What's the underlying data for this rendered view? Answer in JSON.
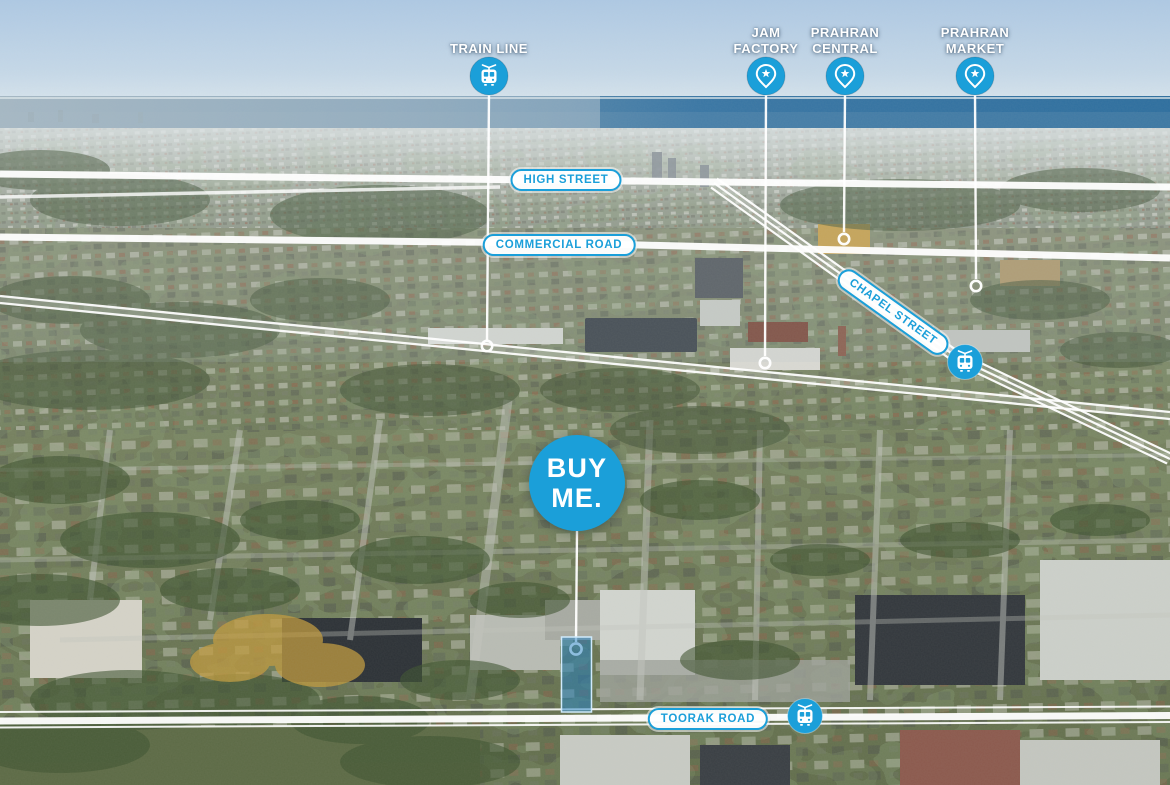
{
  "colors": {
    "accent": "#1b9fd9",
    "annotation_line": "#ffffff",
    "parcel_fill": "#2080c4"
  },
  "landmark_pins": [
    {
      "id": "train-line",
      "label": "TRAIN LINE",
      "icon": "tram-front"
    },
    {
      "id": "jam-factory",
      "label": "JAM FACTORY",
      "icon": "map-pin-star"
    },
    {
      "id": "prahran-central",
      "label": "PRAHRAN CENTRAL",
      "icon": "map-pin-star"
    },
    {
      "id": "prahran-market",
      "label": "PRAHRAN MARKET",
      "icon": "map-pin-star"
    }
  ],
  "street_labels": [
    {
      "id": "high-street",
      "label": "HIGH STREET"
    },
    {
      "id": "commercial-road",
      "label": "COMMERCIAL ROAD"
    },
    {
      "id": "chapel-street",
      "label": "CHAPEL STREET"
    },
    {
      "id": "toorak-road",
      "label": "TOORAK ROAD"
    }
  ],
  "property_marker": {
    "line1": "BUY",
    "line2": "ME."
  },
  "transit_stops": [
    {
      "id": "tram-stop-chapel-street",
      "icon": "tram-front"
    },
    {
      "id": "tram-stop-toorak-road",
      "icon": "tram-front"
    }
  ]
}
